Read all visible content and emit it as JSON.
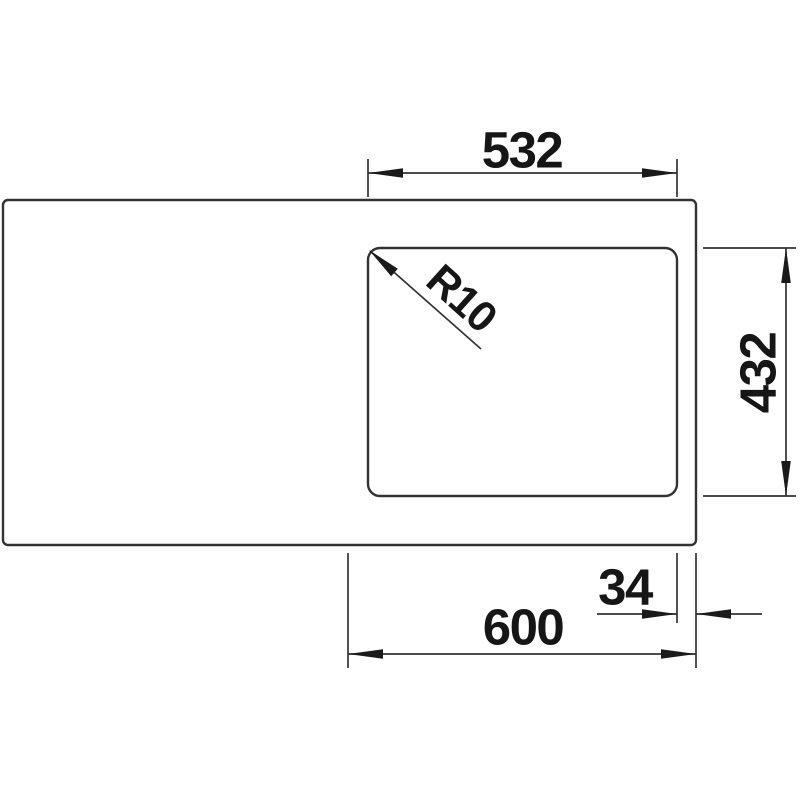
{
  "diagram": {
    "type": "technical-drawing",
    "subject": "sink-top-view-with-dimensions",
    "annotations": {
      "bowl_width": {
        "value": "532",
        "orientation": "horizontal",
        "position": "top"
      },
      "corner_radius": {
        "value": "R10",
        "orientation": "diagonal",
        "position": "bowl-top-left-corner"
      },
      "bowl_depth": {
        "value": "432",
        "orientation": "vertical",
        "position": "right"
      },
      "rim_offset": {
        "value": "34",
        "orientation": "horizontal",
        "position": "bottom-right"
      },
      "cabinet_width": {
        "value": "600",
        "orientation": "horizontal",
        "position": "bottom"
      }
    },
    "colors": {
      "line": "#333333",
      "arrow": "#1a1a1a",
      "text": "#161616",
      "background": "#ffffff"
    }
  }
}
